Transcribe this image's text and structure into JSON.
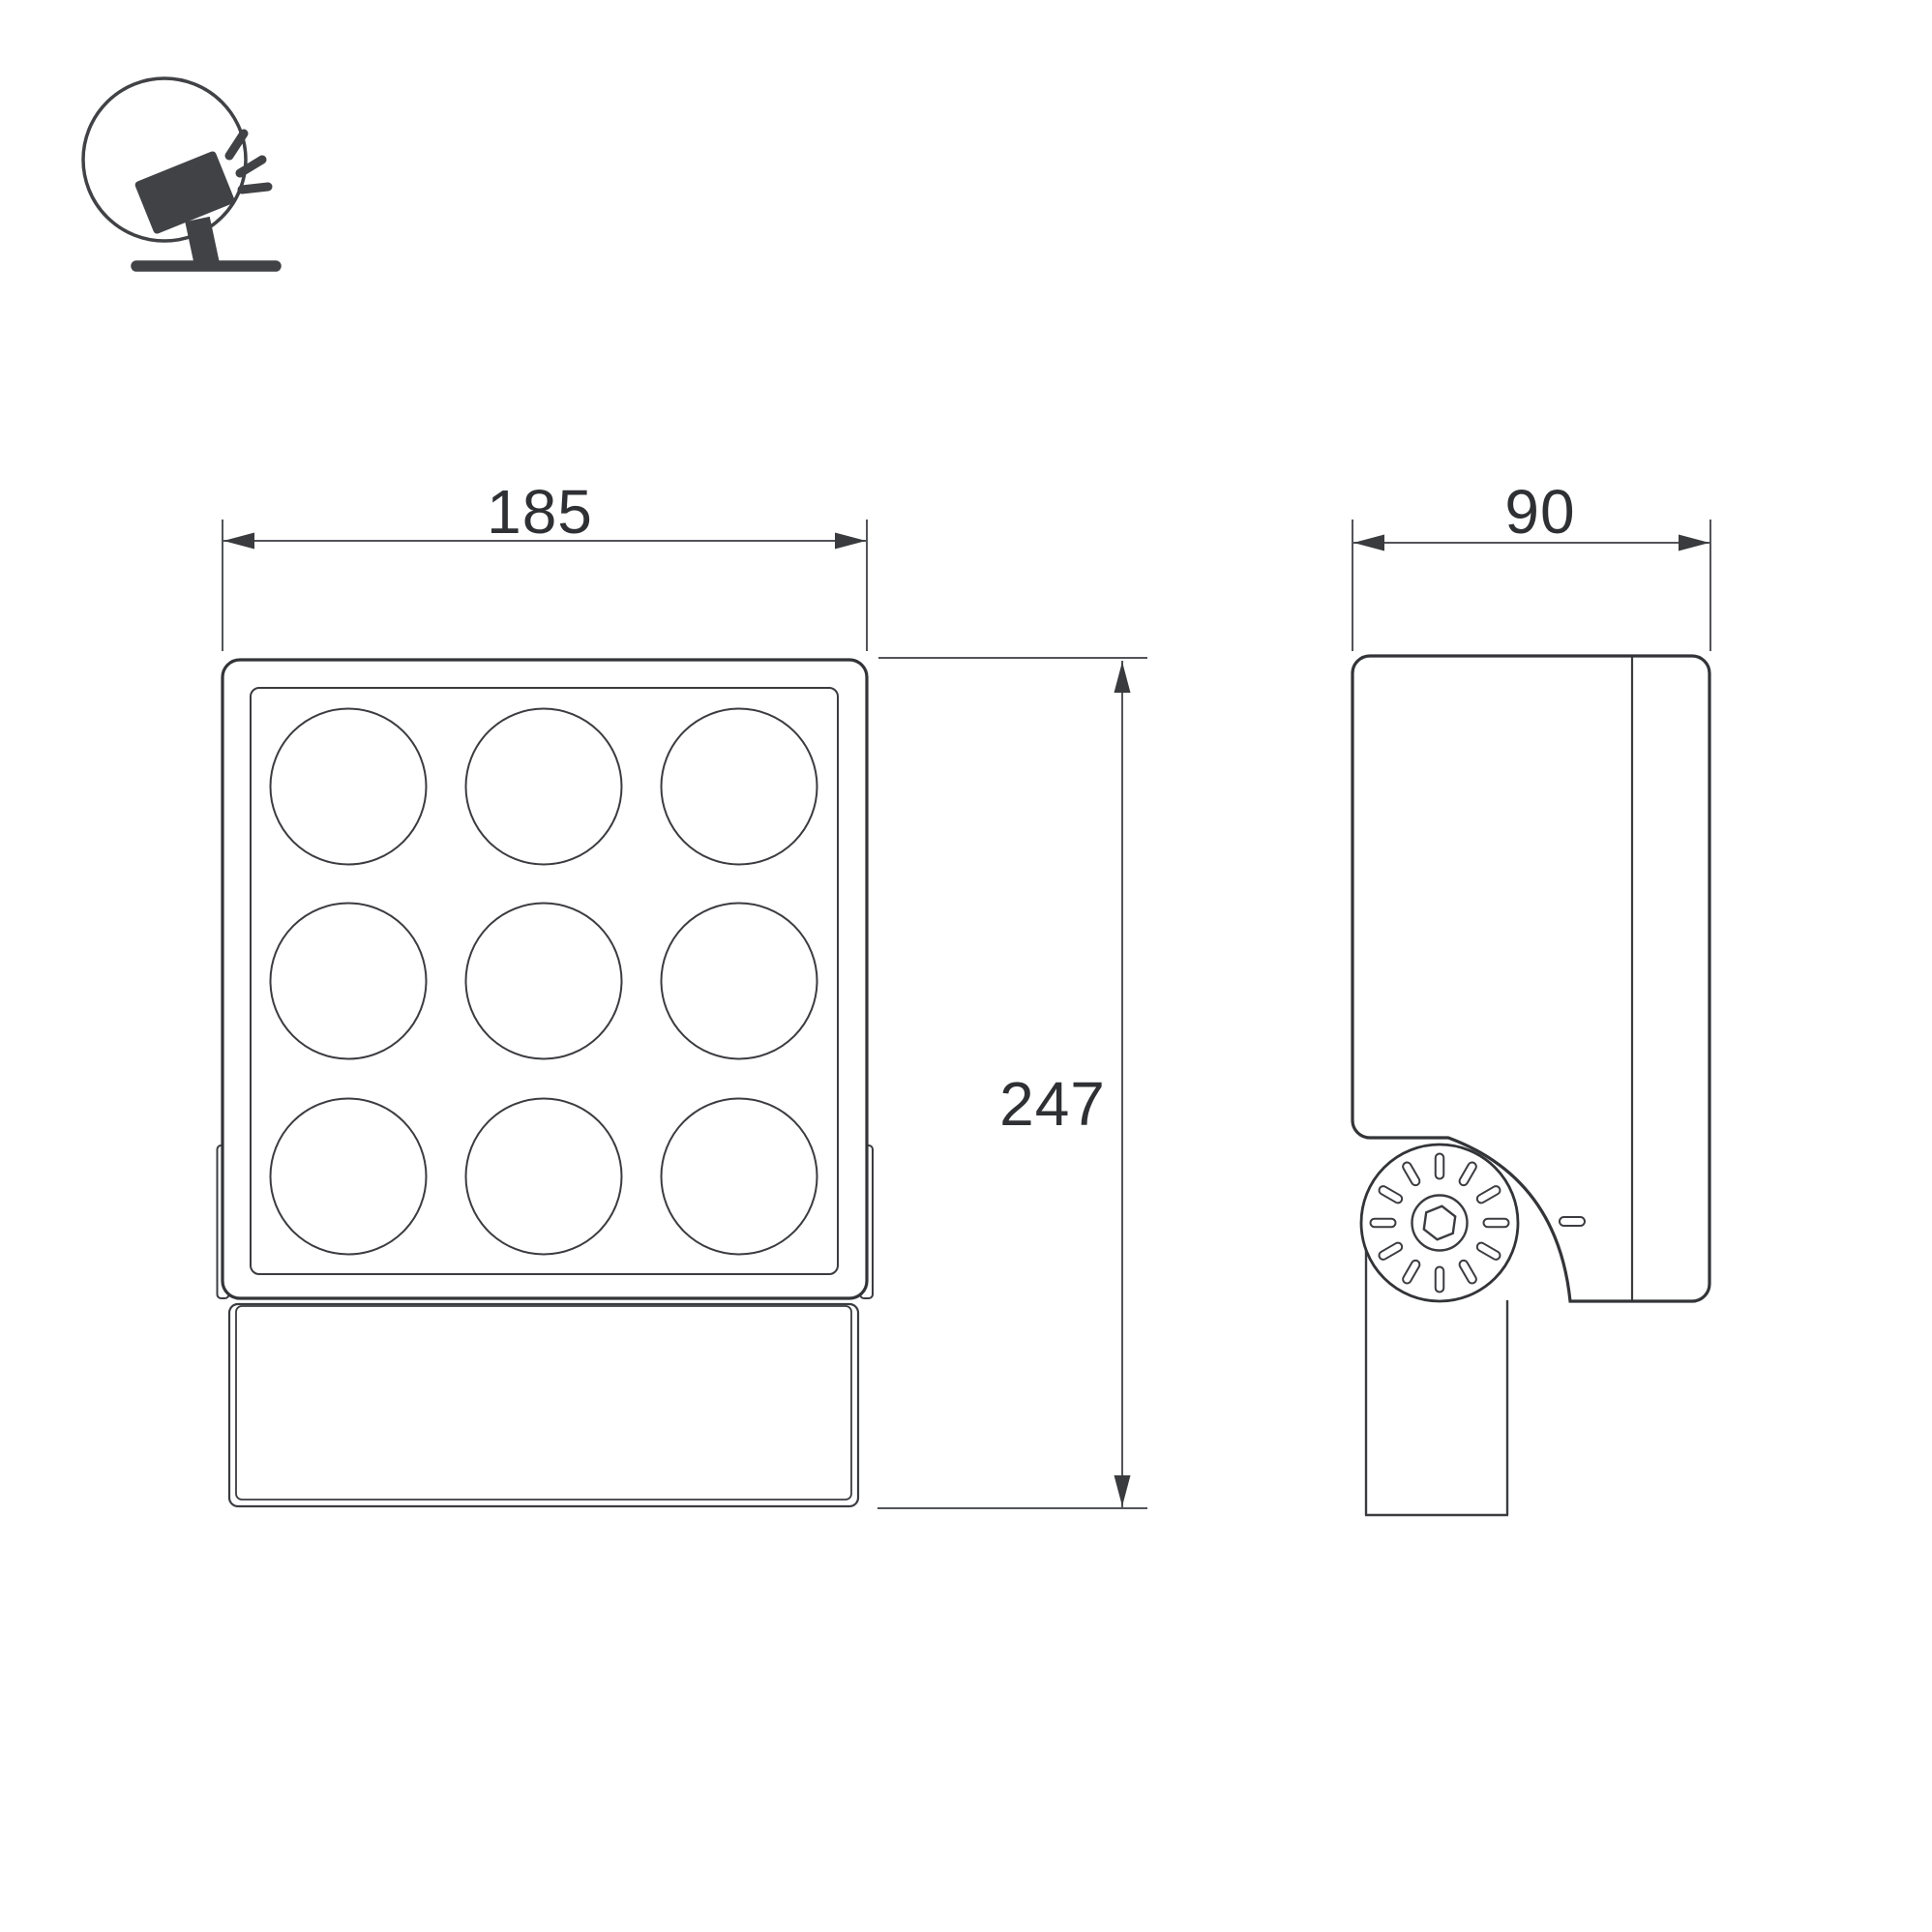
{
  "drawing": {
    "kind": "technical-dimension-drawing",
    "subject": "LED floodlight on pivot bracket",
    "views": {
      "front": {
        "name": "front-view",
        "lens_grid_rows": 3,
        "lens_grid_cols": 3
      },
      "side": {
        "name": "side-view",
        "knob_slot_count": 12
      }
    }
  },
  "icon": {
    "name": "tilted-floodlight-on-stand-icon"
  },
  "dimensions": {
    "front_width": {
      "label": "185"
    },
    "front_height": {
      "label": "247"
    },
    "side_depth": {
      "label": "90"
    }
  },
  "colors": {
    "background": "#ffffff",
    "line_thick": "#333438",
    "line_thin": "#3b3c40",
    "dim_line": "#53545a",
    "arrow": "#3a3b3e",
    "text": "#2f3033",
    "icon": "#414246"
  }
}
